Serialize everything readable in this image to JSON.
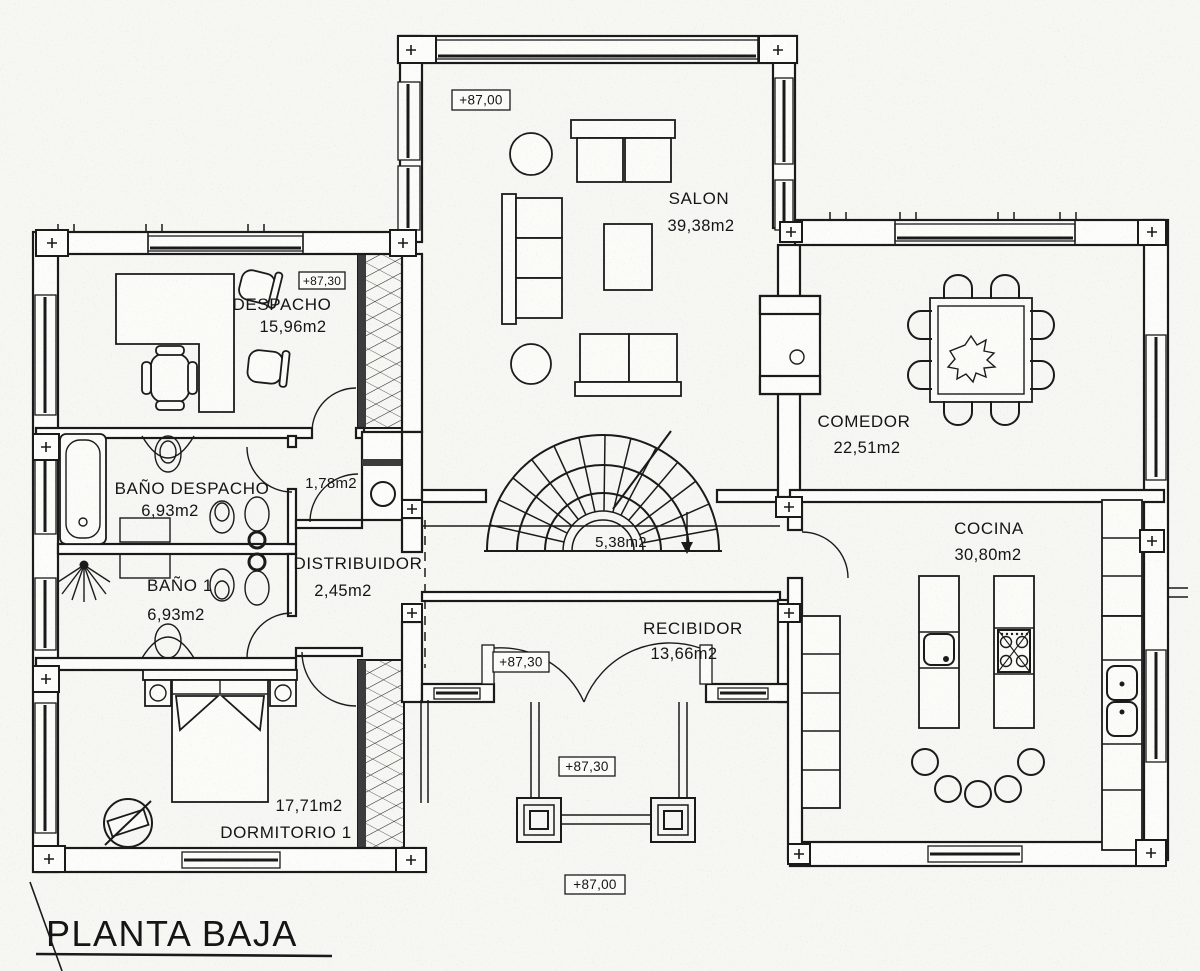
{
  "title": "PLANTA BAJA",
  "rooms": {
    "salon": {
      "name": "SALON",
      "area": "39,38m2"
    },
    "comedor": {
      "name": "COMEDOR",
      "area": "22,51m2"
    },
    "cocina": {
      "name": "COCINA",
      "area": "30,80m2"
    },
    "despacho": {
      "name": "DESPACHO",
      "area": "15,96m2"
    },
    "bano_despacho": {
      "name": "BAÑO DESPACHO",
      "area": "6,93m2"
    },
    "bano_1": {
      "name": "BAÑO 1",
      "area": "6,93m2"
    },
    "dormitorio_1": {
      "name": "DORMITORIO 1",
      "area": "17,71m2"
    },
    "distribuidor": {
      "name": "DISTRIBUIDOR",
      "area": "2,45m2"
    },
    "recibidor": {
      "name": "RECIBIDOR",
      "area": "13,66m2"
    },
    "escalera": {
      "area": "5,38m2"
    },
    "armario_pasillo": {
      "area": "1,78m2"
    }
  },
  "elevations": {
    "salon": "+87,00",
    "despacho": "+87,30",
    "recibidor": "+87,30",
    "porche": "+87,30",
    "terreno": "+87,00"
  },
  "colors": {
    "ink": "#1a1a1a",
    "paper": "#f6f6f3"
  }
}
